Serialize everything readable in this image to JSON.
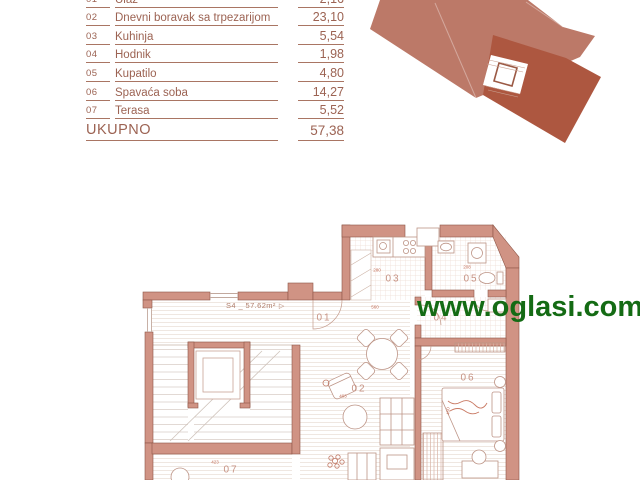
{
  "watermark": {
    "text": "www.oglasi.com",
    "color": "#146b14"
  },
  "area_table": {
    "rows": [
      {
        "num": "01",
        "name": "Ulaz",
        "value": "2,16"
      },
      {
        "num": "02",
        "name": "Dnevni boravak sa trpezarijom",
        "value": "23,10"
      },
      {
        "num": "03",
        "name": "Kuhinja",
        "value": "5,54"
      },
      {
        "num": "04",
        "name": "Hodnik",
        "value": "1,98"
      },
      {
        "num": "05",
        "name": "Kupatilo",
        "value": "4,80"
      },
      {
        "num": "06",
        "name": "Spavaća soba",
        "value": "14,27"
      },
      {
        "num": "07",
        "name": "Terasa",
        "value": "5,52"
      }
    ],
    "total_label": "UKUPNO",
    "total_value": "57,38"
  },
  "floor_plan": {
    "unit_label": "S4 _ 57.62m²",
    "room_labels": [
      {
        "id": "01",
        "x": 194,
        "y": 103
      },
      {
        "id": "02",
        "x": 229,
        "y": 174
      },
      {
        "id": "03",
        "x": 263,
        "y": 64
      },
      {
        "id": "04",
        "x": 311,
        "y": 103
      },
      {
        "id": "05",
        "x": 341,
        "y": 64
      },
      {
        "id": "06",
        "x": 338,
        "y": 163
      },
      {
        "id": "07",
        "x": 101,
        "y": 255
      }
    ],
    "dim_labels": [
      {
        "text": "280",
        "x": 247,
        "y": 55
      },
      {
        "text": "208",
        "x": 337,
        "y": 52
      },
      {
        "text": "560",
        "x": 245,
        "y": 92
      },
      {
        "text": "403",
        "x": 213,
        "y": 181
      },
      {
        "text": "423",
        "x": 85,
        "y": 247
      },
      {
        "text": "450",
        "x": 318,
        "y": 196,
        "rot": -90
      }
    ],
    "colors": {
      "wall": "#d09384",
      "wall_edge": "#8e5546",
      "label": "#c79384",
      "dim": "#c4705a",
      "furniture": "#bd9486"
    }
  },
  "site_plan": {
    "building_color": "#bc7968",
    "unit_color": "#ad5740"
  }
}
